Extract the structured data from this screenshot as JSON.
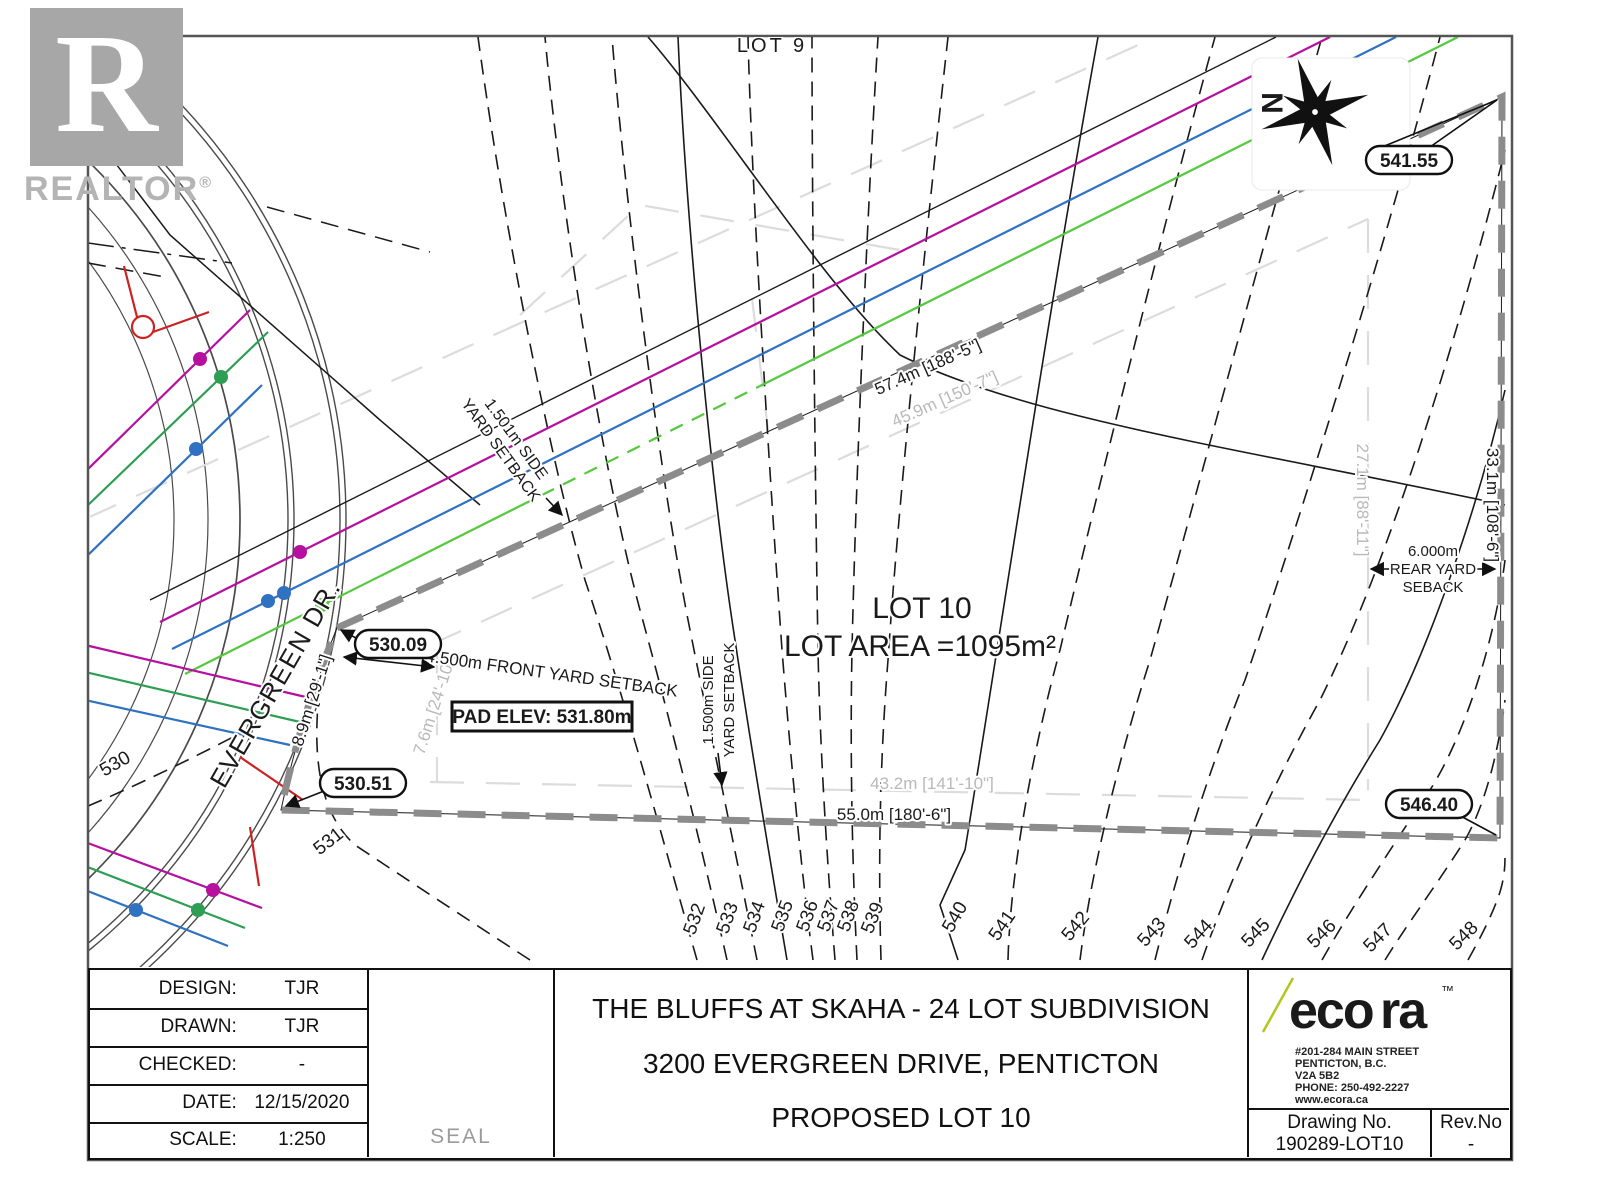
{
  "watermark": {
    "letter": "R",
    "brand": "REALTOR",
    "registered": "®"
  },
  "map": {
    "lot9_label": "LOT 9",
    "north_label": "N",
    "lot_label": "LOT 10",
    "lot_area": "LOT AREA =1095m²",
    "pad_elev": "PAD ELEV: 531.80m",
    "street": "EVERGREEN DR.",
    "spots": {
      "ne": "541.55",
      "w": "530.09",
      "sw": "530.51",
      "se": "546.40"
    },
    "dims": {
      "top": "57.4m [188'-5\"]",
      "top_gray": "45.9m [150'-7\"]",
      "right_gray": "27.1m [88'-11\"]",
      "right": "33.1m [108'-6\"]",
      "bottom_gray": "43.2m [141'-10\"]",
      "bottom": "55.0m [180'-6\"]",
      "west1": "8.9m [29'-1\"]",
      "west2": "7.6m [24'-10\"]"
    },
    "setbacks": {
      "side_top_1": "1.501m SIDE",
      "side_top_2": "YARD SETBACK",
      "front": "4.500m FRONT YARD SETBACK",
      "side_bot_1": "1.500m SIDE",
      "side_bot_2": "YARD SETBACK",
      "rear_1": "6.000m",
      "rear_2": "REAR YARD",
      "rear_3": "SEBACK"
    },
    "contours": [
      "530",
      "531",
      "532",
      "533",
      "534",
      "535",
      "536",
      "537",
      "538",
      "539",
      "540",
      "541",
      "542",
      "543",
      "544",
      "545",
      "546",
      "547",
      "548"
    ]
  },
  "title_block": {
    "rows": [
      {
        "label": "DESIGN:",
        "value": "TJR"
      },
      {
        "label": "DRAWN:",
        "value": "TJR"
      },
      {
        "label": "CHECKED:",
        "value": "-"
      },
      {
        "label": "DATE:",
        "value": "12/15/2020"
      },
      {
        "label": "SCALE:",
        "value": "1:250"
      }
    ],
    "seal": "SEAL",
    "title_lines": [
      "THE BLUFFS AT SKAHA - 24 LOT SUBDIVISION",
      "3200 EVERGREEN DRIVE, PENTICTON",
      "PROPOSED LOT 10"
    ],
    "ecora": {
      "eco": "eco",
      "ra": "ra",
      "tm": "™",
      "address": [
        "#201-284 MAIN STREET",
        "PENTICTON, B.C.",
        "V2A 5B2",
        "PHONE: 250-492-2227",
        "www.ecora.ca"
      ]
    },
    "drawing_no_label": "Drawing No.",
    "drawing_no": "190289-LOT10",
    "rev_label": "Rev.No",
    "rev": "-"
  },
  "colors": {
    "ecora_green": "#b2c61c",
    "ecora_gray": "#57585a",
    "utility_magenta": "#b5109f",
    "utility_blue": "#2f72c2",
    "utility_green_bright": "#54c93c",
    "utility_green_dark": "#2d9e53",
    "hydrant_red": "#cc2222",
    "boundary_gray": "#8c8c8c"
  }
}
